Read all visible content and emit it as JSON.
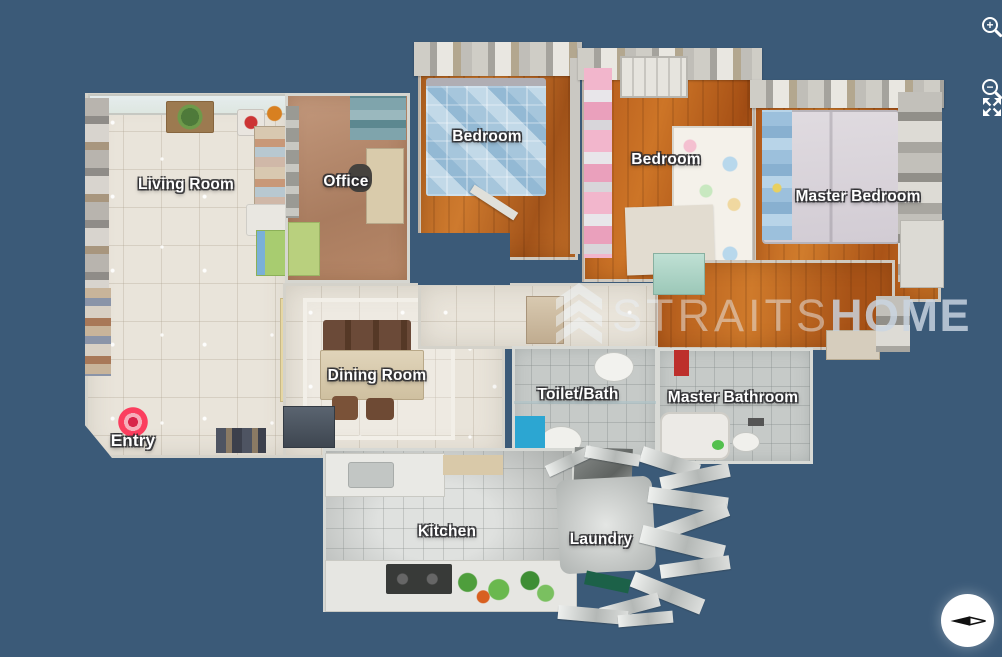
{
  "scene": {
    "type": "3d-dollhouse-floorplan",
    "background_color": "#3b5a78",
    "label_text_color": "#ffffff"
  },
  "watermark": {
    "logo": "chevron-stack-logo",
    "brand_light": "STRAITS",
    "brand_bold": "HOME"
  },
  "rooms": [
    {
      "id": "living-room",
      "label": "Living Room"
    },
    {
      "id": "office",
      "label": "Office"
    },
    {
      "id": "bedroom-1",
      "label": "Bedroom"
    },
    {
      "id": "bedroom-2",
      "label": "Bedroom"
    },
    {
      "id": "master-bedroom",
      "label": "Master Bedroom"
    },
    {
      "id": "dining-room",
      "label": "Dining Room"
    },
    {
      "id": "toilet-bath",
      "label": "Toilet/Bath"
    },
    {
      "id": "master-bathroom",
      "label": "Master Bathroom"
    },
    {
      "id": "kitchen",
      "label": "Kitchen"
    },
    {
      "id": "laundry",
      "label": "Laundry"
    }
  ],
  "entry": {
    "label": "Entry",
    "marker_color": "#fb3e5e"
  },
  "controls": {
    "zoom_in_icon": "magnifier-plus",
    "zoom_in_glyph": "+",
    "zoom_out_icon": "magnifier-minus",
    "zoom_out_glyph": "−",
    "fullscreen_icon": "expand-arrows",
    "compass_icon": "compass-needle"
  }
}
